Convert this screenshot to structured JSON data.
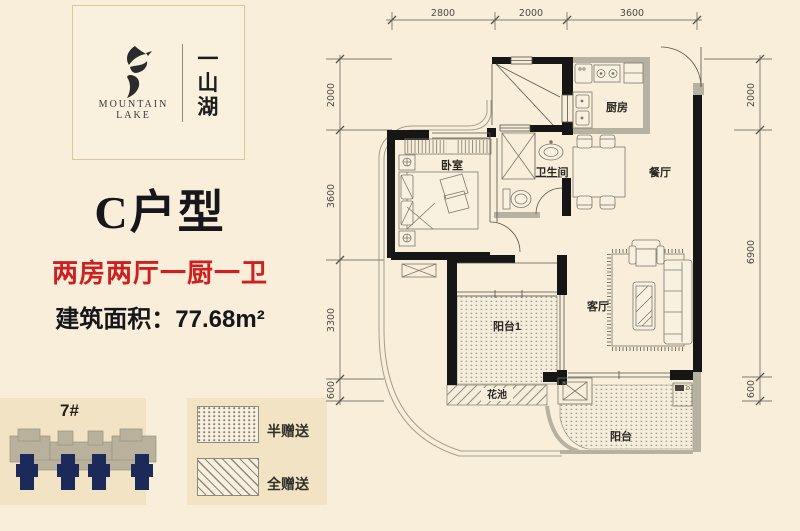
{
  "brand": {
    "en_line1": "MOUNTAIN",
    "en_line2": "LAKE",
    "cn_chars": [
      "一",
      "山",
      "湖"
    ]
  },
  "unit": {
    "title": "C户型",
    "layout": "两房两厅一厨一卫",
    "area": "建筑面积：77.68m²"
  },
  "site": {
    "building": "7#"
  },
  "legend": {
    "half": "半赠送",
    "full": "全赠送"
  },
  "plan": {
    "rooms": {
      "bedroom": "卧室",
      "bathroom": "卫生间",
      "kitchen": "厨房",
      "dining": "餐厅",
      "living": "客厅",
      "balcony1": "阳台1",
      "flowerbed": "花池",
      "balcony": "阳台"
    },
    "dims_top": [
      "2800",
      "2000",
      "3600"
    ],
    "dims_left": [
      "2000",
      "3600",
      "3300",
      "600"
    ],
    "dims_right": [
      "2000",
      "6900",
      "600"
    ]
  },
  "colors": {
    "page_bg": "#f8eeda",
    "accent_red": "#d01f1f",
    "tower_navy": "#1c2a5a",
    "wall_black": "#161616",
    "panel_tan": "#f1e3c3"
  }
}
